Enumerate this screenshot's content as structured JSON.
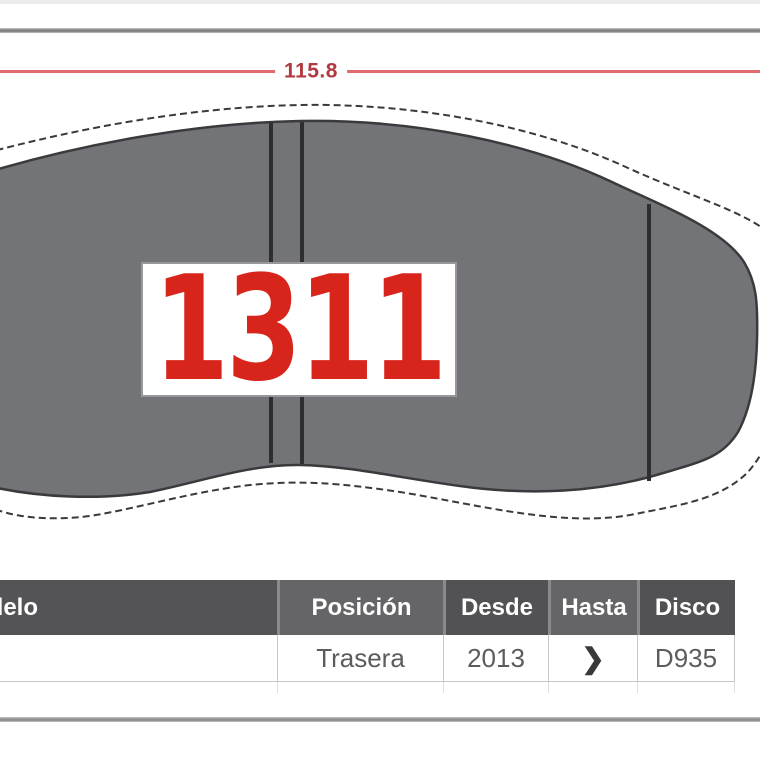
{
  "dimension": {
    "value": "115.8"
  },
  "pad": {
    "part_number": "1311"
  },
  "table": {
    "headers": [
      {
        "id": "modelo",
        "label": "Modelo"
      },
      {
        "id": "posicion",
        "label": "Posición"
      },
      {
        "id": "desde",
        "label": "Desde"
      },
      {
        "id": "hasta",
        "label": "Hasta"
      },
      {
        "id": "disco",
        "label": "Disco"
      }
    ],
    "row": {
      "modelo": "",
      "posicion": "Trasera",
      "desde": "2013",
      "hasta": "❯",
      "disco": "D935"
    }
  },
  "colors": {
    "accent_red": "#d8251c",
    "dimension_line": "#e06a6e",
    "dimension_text": "#b03a40",
    "pad_gray": "#737478",
    "pad_outline": "#3a3a3c",
    "header_dark": "#545457",
    "header_light": "#656568",
    "divider_gray": "#8a8a8d"
  }
}
